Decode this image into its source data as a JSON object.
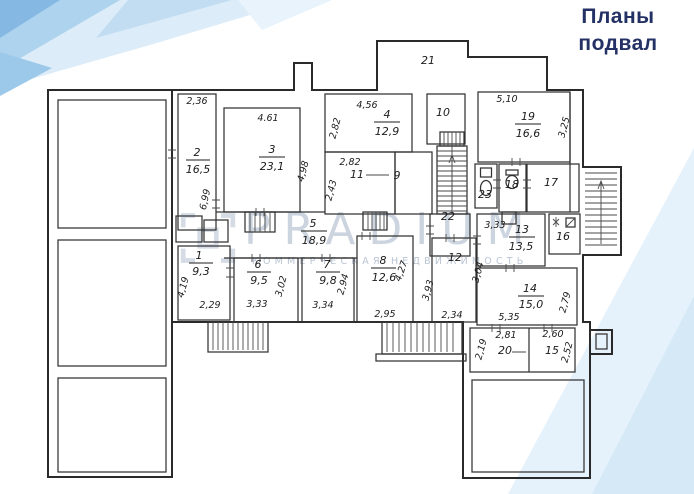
{
  "header": {
    "title_line1": "Планы",
    "title_line2": "подвал"
  },
  "watermark": {
    "brand": "PRADIUM",
    "tagline": "КОММЕРЧЕСКАЯ НЕДВИЖИМОСТЬ"
  },
  "colors": {
    "title_navy": "#243165",
    "plan_line": "#2f2f2f",
    "decor_blue_light": "#dcecf8",
    "decor_blue_mid": "#9cc8ea",
    "corner_triangle": "#e6f2fb",
    "watermark_gray": "#b4c1d2"
  },
  "rooms": {
    "r1": {
      "number": "1",
      "area": "9,3",
      "dim_side": "4,19",
      "dim_bottom": "2,29"
    },
    "r2": {
      "number": "2",
      "area": "16,5",
      "dim_top": "2,36",
      "dim_side": "6,99"
    },
    "r3": {
      "number": "3",
      "area": "23,1",
      "dim_top": "4.61",
      "dim_side": "4,98"
    },
    "r4": {
      "number": "4",
      "area": "12,9",
      "dim_top": "4,56",
      "dim_side": "2,82"
    },
    "r5": {
      "number": "5",
      "area": "18,9"
    },
    "r6": {
      "number": "6",
      "area": "9,5",
      "dim_bottom": "3,33",
      "dim_side": "3,02"
    },
    "r7": {
      "number": "7",
      "area": "9,8",
      "dim_bottom": "3,34",
      "dim_side": "2,94"
    },
    "r8": {
      "number": "8",
      "area": "12,6",
      "dim_side": "4,27",
      "dim_bottom": "2,95"
    },
    "r9": {
      "number": "9"
    },
    "r10": {
      "number": "10"
    },
    "r11": {
      "number": "11",
      "dim_top": "2,82",
      "dim_side": "2,43"
    },
    "r12": {
      "number": "12",
      "dim_side": "3,93",
      "dim_bottom": "2,34"
    },
    "r13": {
      "number": "13",
      "area": "13,5",
      "dim_top": "3,33",
      "dim_side": "3,04"
    },
    "r14": {
      "number": "14",
      "area": "15,0",
      "dim_bottom": "5,35",
      "dim_side": "2,79"
    },
    "r15": {
      "number": "15",
      "dim_top": "2,60",
      "dim_side": "2,52"
    },
    "r16": {
      "number": "16"
    },
    "r17": {
      "number": "17"
    },
    "r18": {
      "number": "18"
    },
    "r19": {
      "number": "19",
      "area": "16,6",
      "dim_top": "5,10",
      "dim_side": "3,25"
    },
    "r20": {
      "number": "20",
      "dim_top": "2,81",
      "dim_side": "2,19"
    },
    "r21": {
      "number": "21"
    },
    "r22": {
      "number": "22"
    },
    "r23": {
      "number": "23"
    }
  }
}
